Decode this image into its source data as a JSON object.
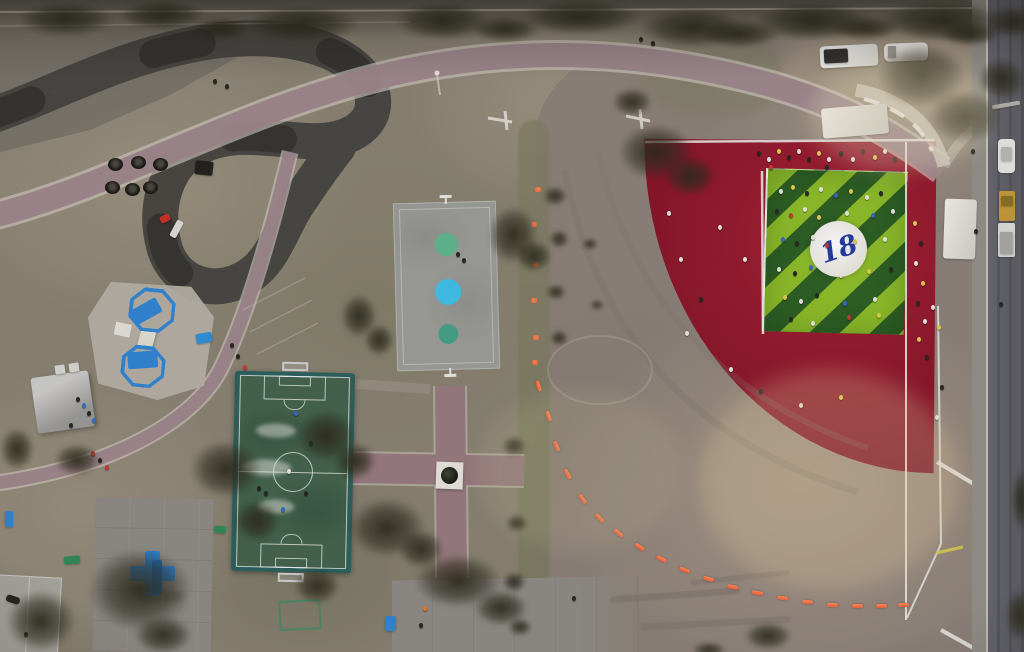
{
  "image_type": "aerial-drone-photo-of-park",
  "logo_text": "18",
  "colors": {
    "palette": {
      "grass": "#8a8270",
      "dirt": "#8d8177",
      "redclay": "#8c1527",
      "greenlight": "#8ebe26",
      "greendark": "#2c5e20",
      "courtgray": "#9c9c96",
      "circteal": "#57b98c",
      "circblue": "#3fc0e8",
      "soccergreen": "#42624b",
      "soccerframe": "#2a5f5b",
      "pathmauve": "#9c8489",
      "brick": "#96777b",
      "asphalt": "#45423c",
      "plaza": "#8e8b84",
      "road": "#5c5c60",
      "bluestruct": "#2f84d2",
      "cone": "#f0603a",
      "white": "#e9e7e0"
    },
    "people": {
      "w": "#eae8e1",
      "k": "#26251f",
      "y": "#e3cf4b",
      "r": "#c8392c",
      "b": "#3a66c8",
      "b2": "#2f6fc0",
      "o": "#e87b20"
    }
  },
  "scene": {
    "trees": [
      [
        18,
        2,
        95,
        34
      ],
      [
        120,
        0,
        85,
        30
      ],
      [
        245,
        6,
        115,
        36
      ],
      [
        395,
        2,
        95,
        38
      ],
      [
        520,
        0,
        120,
        34
      ],
      [
        640,
        8,
        105,
        40
      ],
      [
        755,
        2,
        115,
        38
      ],
      [
        880,
        0,
        125,
        42
      ],
      [
        985,
        6,
        55,
        32
      ],
      [
        190,
        18,
        60,
        22
      ],
      [
        470,
        16,
        70,
        26
      ],
      [
        700,
        20,
        80,
        28
      ],
      [
        830,
        16,
        70,
        24
      ],
      [
        940,
        22,
        60,
        24
      ],
      [
        618,
        124,
        76,
        56
      ],
      [
        664,
        156,
        52,
        40
      ],
      [
        488,
        206,
        50,
        58
      ],
      [
        516,
        240,
        36,
        32
      ],
      [
        341,
        294,
        36,
        44
      ],
      [
        364,
        324,
        30,
        32
      ],
      [
        296,
        410,
        60,
        52
      ],
      [
        334,
        442,
        42,
        38
      ],
      [
        348,
        498,
        78,
        60
      ],
      [
        398,
        530,
        46,
        38
      ],
      [
        190,
        440,
        72,
        58
      ],
      [
        234,
        500,
        46,
        42
      ],
      [
        54,
        444,
        46,
        32
      ],
      [
        0,
        428,
        34,
        42
      ],
      [
        88,
        548,
        104,
        84
      ],
      [
        6,
        590,
        70,
        62
      ],
      [
        134,
        616,
        58,
        38
      ],
      [
        294,
        568,
        46,
        36
      ],
      [
        414,
        554,
        88,
        54
      ],
      [
        474,
        590,
        54,
        36
      ],
      [
        876,
        44,
        90,
        64
      ],
      [
        928,
        90,
        74,
        54
      ],
      [
        978,
        58,
        48,
        42
      ],
      [
        744,
        622,
        48,
        28
      ],
      [
        692,
        642,
        34,
        16
      ],
      [
        612,
        88,
        40,
        28
      ],
      [
        543,
        186,
        24,
        20
      ],
      [
        549,
        230,
        20,
        18
      ],
      [
        546,
        284,
        20,
        16
      ],
      [
        550,
        330,
        18,
        16
      ],
      [
        502,
        436,
        24,
        20
      ],
      [
        506,
        514,
        22,
        18
      ],
      [
        502,
        572,
        24,
        20
      ],
      [
        508,
        618,
        24,
        18
      ],
      [
        1006,
        590,
        26,
        50
      ],
      [
        1012,
        470,
        18,
        60
      ],
      [
        582,
        238,
        16,
        12
      ],
      [
        590,
        300,
        14,
        10
      ]
    ],
    "tires": [
      [
        108,
        158
      ],
      [
        131,
        156
      ],
      [
        153,
        158
      ],
      [
        105,
        181
      ],
      [
        125,
        183
      ],
      [
        143,
        181
      ]
    ],
    "cones": [
      {
        "x": 535,
        "y": 187,
        "r": 0,
        "t": "dot"
      },
      {
        "x": 531,
        "y": 222,
        "r": 0,
        "t": "dot"
      },
      {
        "x": 533,
        "y": 262,
        "r": 0,
        "t": "dot"
      },
      {
        "x": 531,
        "y": 298,
        "r": 0,
        "t": "dot"
      },
      {
        "x": 533,
        "y": 335,
        "r": 0,
        "t": "dot"
      },
      {
        "x": 532,
        "y": 360,
        "r": 0,
        "t": "dot"
      },
      {
        "x": 533,
        "y": 384,
        "r": 72,
        "t": "bar"
      },
      {
        "x": 543,
        "y": 414,
        "r": 70,
        "t": "bar"
      },
      {
        "x": 551,
        "y": 444,
        "r": 66,
        "t": "bar"
      },
      {
        "x": 562,
        "y": 472,
        "r": 60,
        "t": "bar"
      },
      {
        "x": 577,
        "y": 497,
        "r": 54,
        "t": "bar"
      },
      {
        "x": 594,
        "y": 516,
        "r": 47,
        "t": "bar"
      },
      {
        "x": 613,
        "y": 531,
        "r": 40,
        "t": "bar"
      },
      {
        "x": 634,
        "y": 545,
        "r": 33,
        "t": "bar"
      },
      {
        "x": 656,
        "y": 557,
        "r": 27,
        "t": "bar"
      },
      {
        "x": 679,
        "y": 568,
        "r": 21,
        "t": "bar"
      },
      {
        "x": 703,
        "y": 577,
        "r": 16,
        "t": "bar"
      },
      {
        "x": 727,
        "y": 585,
        "r": 12,
        "t": "bar"
      },
      {
        "x": 752,
        "y": 591,
        "r": 9,
        "t": "bar"
      },
      {
        "x": 777,
        "y": 596,
        "r": 7,
        "t": "bar"
      },
      {
        "x": 802,
        "y": 600,
        "r": 5,
        "t": "bar"
      },
      {
        "x": 827,
        "y": 603,
        "r": 3,
        "t": "bar"
      },
      {
        "x": 852,
        "y": 604,
        "r": 1,
        "t": "bar"
      },
      {
        "x": 876,
        "y": 604,
        "r": 0,
        "t": "bar"
      },
      {
        "x": 898,
        "y": 603,
        "r": -2,
        "t": "bar"
      }
    ],
    "people": {
      "green_square_crowd": [
        [
          779,
          189,
          "w"
        ],
        [
          791,
          185,
          "y"
        ],
        [
          805,
          191,
          "k"
        ],
        [
          819,
          187,
          "w"
        ],
        [
          834,
          193,
          "b"
        ],
        [
          849,
          189,
          "y"
        ],
        [
          865,
          195,
          "w"
        ],
        [
          879,
          191,
          "k"
        ],
        [
          775,
          209,
          "k"
        ],
        [
          789,
          213,
          "r"
        ],
        [
          803,
          207,
          "w"
        ],
        [
          817,
          215,
          "y"
        ],
        [
          845,
          211,
          "w"
        ],
        [
          871,
          213,
          "b"
        ],
        [
          891,
          209,
          "w"
        ],
        [
          781,
          237,
          "b"
        ],
        [
          795,
          241,
          "k"
        ],
        [
          811,
          235,
          "w"
        ],
        [
          825,
          243,
          "r"
        ],
        [
          853,
          239,
          "y"
        ],
        [
          883,
          237,
          "w"
        ],
        [
          777,
          267,
          "w"
        ],
        [
          793,
          271,
          "k"
        ],
        [
          809,
          265,
          "b"
        ],
        [
          839,
          273,
          "w"
        ],
        [
          867,
          269,
          "y"
        ],
        [
          889,
          267,
          "k"
        ],
        [
          783,
          295,
          "y"
        ],
        [
          799,
          299,
          "w"
        ],
        [
          815,
          293,
          "k"
        ],
        [
          843,
          301,
          "b"
        ],
        [
          873,
          297,
          "w"
        ],
        [
          789,
          317,
          "k"
        ],
        [
          811,
          321,
          "w"
        ],
        [
          847,
          315,
          "r"
        ],
        [
          877,
          313,
          "y"
        ]
      ],
      "top_sideline_crowd": [
        [
          757,
          151,
          "k"
        ],
        [
          767,
          157,
          "w"
        ],
        [
          777,
          149,
          "y"
        ],
        [
          787,
          155,
          "k"
        ],
        [
          797,
          149,
          "w"
        ],
        [
          807,
          157,
          "k"
        ],
        [
          817,
          151,
          "y"
        ],
        [
          827,
          157,
          "w"
        ],
        [
          839,
          151,
          "k"
        ],
        [
          851,
          157,
          "w"
        ],
        [
          861,
          149,
          "k"
        ],
        [
          873,
          155,
          "y"
        ],
        [
          883,
          149,
          "w"
        ],
        [
          893,
          157,
          "k"
        ],
        [
          769,
          165,
          "r"
        ],
        [
          825,
          165,
          "k"
        ]
      ],
      "red_clay_scatter": [
        [
          667,
          211,
          "w"
        ],
        [
          679,
          257,
          "w"
        ],
        [
          699,
          297,
          "k"
        ],
        [
          685,
          331,
          "w"
        ],
        [
          729,
          367,
          "w"
        ],
        [
          759,
          389,
          "k"
        ],
        [
          799,
          403,
          "w"
        ],
        [
          839,
          395,
          "y"
        ],
        [
          743,
          257,
          "w"
        ],
        [
          718,
          225,
          "w"
        ]
      ],
      "fence_line_people": [
        [
          913,
          221,
          "y"
        ],
        [
          919,
          241,
          "k"
        ],
        [
          914,
          261,
          "w"
        ],
        [
          921,
          281,
          "y"
        ],
        [
          916,
          301,
          "k"
        ],
        [
          923,
          319,
          "w"
        ],
        [
          917,
          337,
          "y"
        ],
        [
          925,
          355,
          "k"
        ],
        [
          931,
          305,
          "w"
        ],
        [
          937,
          325,
          "y"
        ],
        [
          940,
          385,
          "k"
        ],
        [
          935,
          415,
          "w"
        ]
      ],
      "path_walkers": [
        [
          230,
          343,
          "k"
        ],
        [
          236,
          354,
          "k"
        ],
        [
          243,
          365,
          "r"
        ],
        [
          91,
          451,
          "r"
        ],
        [
          98,
          458,
          "k"
        ],
        [
          105,
          465,
          "r"
        ],
        [
          257,
          486,
          "k"
        ],
        [
          264,
          491,
          "k"
        ],
        [
          639,
          37,
          "k"
        ],
        [
          651,
          41,
          "k"
        ],
        [
          213,
          79,
          "k"
        ],
        [
          225,
          84,
          "k"
        ],
        [
          456,
          252,
          "k"
        ],
        [
          462,
          258,
          "k"
        ],
        [
          24,
          632,
          "k"
        ]
      ],
      "canopy_people": [
        [
          76,
          397,
          "k"
        ],
        [
          82,
          403,
          "b2"
        ],
        [
          87,
          411,
          "k"
        ],
        [
          92,
          418,
          "b2"
        ],
        [
          69,
          423,
          "k"
        ]
      ],
      "plaza_people": [
        [
          423,
          606,
          "o"
        ],
        [
          419,
          623,
          "k"
        ],
        [
          572,
          596,
          "k"
        ]
      ],
      "soccer_players": [
        [
          294,
          411,
          "b"
        ],
        [
          287,
          469,
          "w"
        ],
        [
          304,
          491,
          "k"
        ],
        [
          281,
          507,
          "b2"
        ],
        [
          309,
          441,
          "k"
        ]
      ],
      "road_pedestrians": [
        [
          971,
          149,
          "k"
        ],
        [
          974,
          229,
          "k"
        ],
        [
          999,
          302,
          "k"
        ]
      ]
    },
    "sprites": [
      {
        "n": "pickup-truck",
        "x": 820,
        "y": 45,
        "w": 58,
        "h": 22,
        "c": "linear-gradient(90deg,#f0efeb 30%,#dddbd5)",
        "br": 4,
        "r": -3
      },
      {
        "n": "pickup-truck-bed",
        "x": 824,
        "y": 49,
        "w": 24,
        "h": 14,
        "c": "#2e2d29",
        "br": 2,
        "r": -3
      },
      {
        "n": "white-van",
        "x": 884,
        "y": 43,
        "w": 44,
        "h": 18,
        "c": "#eceae5",
        "br": 5,
        "r": -2
      },
      {
        "n": "van-windshield",
        "x": 888,
        "y": 46,
        "w": 8,
        "h": 12,
        "c": "#9a988f",
        "br": 1
      },
      {
        "n": "parked-car-road",
        "x": 998,
        "y": 139,
        "w": 17,
        "h": 34,
        "c": "#e8e6e1",
        "br": 4
      },
      {
        "n": "car-roof",
        "x": 1001,
        "y": 147,
        "w": 11,
        "h": 14,
        "c": "#b9b7b0",
        "br": 2
      },
      {
        "n": "yellow-machine",
        "x": 999,
        "y": 191,
        "w": 16,
        "h": 30,
        "c": "#c49a33",
        "br": 2
      },
      {
        "n": "machine-cab",
        "x": 1001,
        "y": 196,
        "w": 12,
        "h": 10,
        "c": "#8a6f1f",
        "br": 1
      },
      {
        "n": "tow-truck",
        "x": 998,
        "y": 223,
        "w": 17,
        "h": 34,
        "c": "#dddbd4",
        "br": 2
      },
      {
        "n": "tow-truck-bed",
        "x": 1000,
        "y": 232,
        "w": 13,
        "h": 22,
        "c": "#a9a79f",
        "br": 1
      },
      {
        "n": "white-canopy-tent",
        "x": 822,
        "y": 106,
        "w": 66,
        "h": 30,
        "c": "linear-gradient(120deg,#f4f2ec,#cfccc2)",
        "br": 3,
        "r": -5
      },
      {
        "n": "white-tent-roadside",
        "x": 944,
        "y": 199,
        "w": 32,
        "h": 60,
        "c": "linear-gradient(105deg,#f2f0ea,#d2cfc5)",
        "br": 3,
        "r": 2
      },
      {
        "n": "green-bench",
        "x": 64,
        "y": 556,
        "w": 16,
        "h": 8,
        "c": "#2f8a52",
        "br": 2,
        "r": -4
      },
      {
        "n": "green-bench",
        "x": 214,
        "y": 526,
        "w": 12,
        "h": 7,
        "c": "#2f8a52",
        "br": 2,
        "r": 3
      },
      {
        "n": "blue-bench",
        "x": 5,
        "y": 511,
        "w": 8,
        "h": 16,
        "c": "#2f84d2",
        "br": 2
      },
      {
        "n": "blue-bench",
        "x": 385,
        "y": 616,
        "w": 11,
        "h": 15,
        "c": "#2f84d2",
        "br": 2
      },
      {
        "n": "blue-mat",
        "x": 196,
        "y": 333,
        "w": 16,
        "h": 10,
        "c": "#2f8fd6",
        "br": 2,
        "r": -10
      },
      {
        "n": "dark-mat",
        "x": 195,
        "y": 161,
        "w": 18,
        "h": 14,
        "c": "#201f1a",
        "br": 2,
        "r": 6
      },
      {
        "n": "white-storage-box",
        "x": 55,
        "y": 365,
        "w": 10,
        "h": 9,
        "c": "#d9d7d1",
        "br": 1,
        "r": -8
      },
      {
        "n": "white-storage-box",
        "x": 69,
        "y": 363,
        "w": 10,
        "h": 9,
        "c": "#d9d7d1",
        "br": 1,
        "r": -8
      },
      {
        "n": "red-gokart",
        "x": 160,
        "y": 215,
        "w": 10,
        "h": 7,
        "c": "#c93026",
        "br": 2,
        "r": -25
      },
      {
        "n": "white-trailer",
        "x": 173,
        "y": 220,
        "w": 7,
        "h": 18,
        "c": "#dedcd4",
        "br": 2,
        "r": 28
      },
      {
        "n": "scooter",
        "x": 6,
        "y": 596,
        "w": 14,
        "h": 7,
        "c": "#23221e",
        "br": 3,
        "r": 18
      },
      {
        "n": "tire-streak",
        "x": 610,
        "y": 592,
        "w": 130,
        "h": 5,
        "c": "#7b7268",
        "br": 3,
        "r": -4,
        "o": 0.5
      },
      {
        "n": "tire-streak",
        "x": 640,
        "y": 620,
        "w": 150,
        "h": 5,
        "c": "#7b7268",
        "br": 3,
        "r": -3,
        "o": 0.45
      },
      {
        "n": "tire-streak",
        "x": 690,
        "y": 575,
        "w": 100,
        "h": 4,
        "c": "#7b7268",
        "br": 2,
        "r": -6,
        "o": 0.4
      },
      {
        "n": "road-marking",
        "x": 992,
        "y": 103,
        "w": 28,
        "h": 4,
        "c": "#d8d4c8",
        "br": 1,
        "r": -10,
        "o": 0.7
      }
    ]
  }
}
